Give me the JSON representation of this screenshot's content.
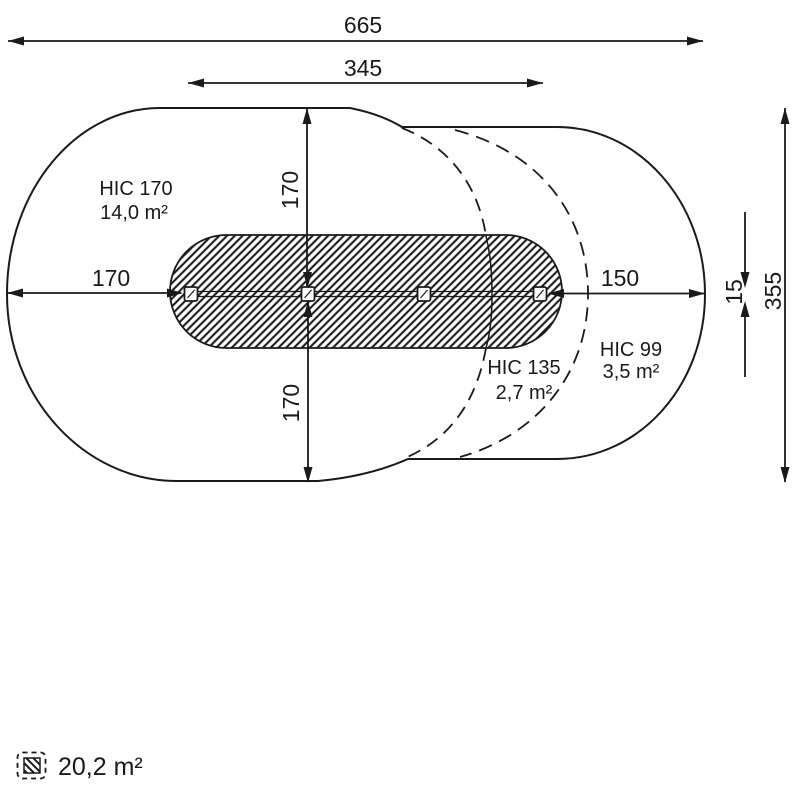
{
  "diagram": {
    "title": "playground-swing-safety-zone-plan",
    "dimensions": {
      "total_width": "665",
      "post_span": "345",
      "left_clearance": "170",
      "right_clearance": "150",
      "vertical_up": "170",
      "vertical_down": "170",
      "total_height": "355",
      "beam_thickness": "15"
    },
    "zones": [
      {
        "name": "HIC 170",
        "area": "14,0 m²",
        "style": "solid-outline-left"
      },
      {
        "name": "HIC 135",
        "area": "2,7 m²",
        "style": "dashed-outline-middle"
      },
      {
        "name": "HIC 99",
        "area": "3,5 m²",
        "style": "solid-outline-right"
      }
    ],
    "legend": {
      "hatched_area": "20,2 m²"
    },
    "colors": {
      "line": "#1a1a1a",
      "background": "#ffffff"
    }
  }
}
